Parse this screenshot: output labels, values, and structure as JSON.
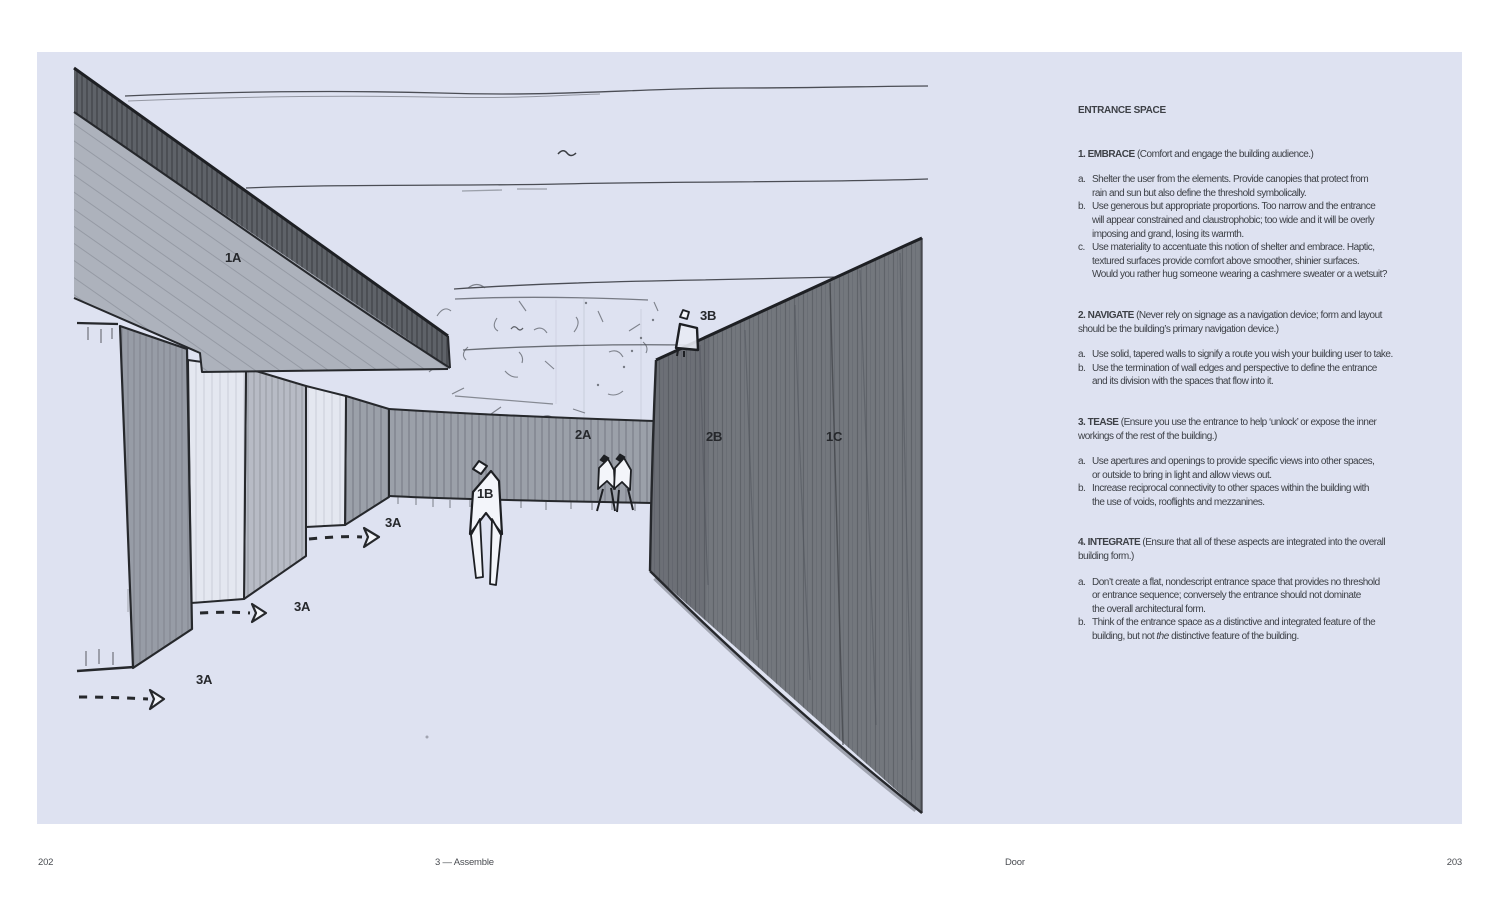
{
  "colors": {
    "page_bg": "#ffffff",
    "panel_bg": "#dee2f1",
    "ink": "#26282c",
    "text": "#3d4046",
    "footer_text": "#4a4d52",
    "wall_dark": "#73777d",
    "wall_band": "#9ba0a9",
    "fin_dark": "#979ca6",
    "fin_mid": "#b7bbc5",
    "fin_light": "#e4e7f0",
    "fascia": "#5e6268",
    "canopy_under": "#adb2bc",
    "figure_fill": "#f3f5fa"
  },
  "sketch": {
    "description": "hand sketch of an entrance corridor in one-point perspective",
    "labels": {
      "l1a": "1A",
      "l1b": "1B",
      "l1c": "1C",
      "l2a": "2A",
      "l2b": "2B",
      "l3b": "3B",
      "l3a_1": "3A",
      "l3a_2": "3A",
      "l3a_3": "3A"
    }
  },
  "article": {
    "title": "ENTRANCE SPACE",
    "sections": [
      {
        "heading_bold": "1. EMBRACE",
        "heading_rest": " (Comfort and engage the building audience.)",
        "items": [
          {
            "label": "a.",
            "text": "Shelter the user from the elements. Provide canopies that protect from\nrain and sun but also define the threshold symbolically."
          },
          {
            "label": "b.",
            "text": "Use generous but appropriate proportions. Too narrow and the entrance\nwill appear constrained and claustrophobic; too wide and it will be overly\nimposing and grand, losing its warmth."
          },
          {
            "label": "c.",
            "text": "Use materiality to accentuate this notion of shelter and embrace. Haptic,\ntextured surfaces provide comfort above smoother, shinier surfaces.\nWould you rather hug someone wearing a cashmere sweater or a wetsuit?"
          }
        ]
      },
      {
        "heading_bold": "2. NAVIGATE",
        "heading_rest": " (Never rely on signage as a navigation device; form and layout\nshould be the building’s primary navigation device.)",
        "items": [
          {
            "label": "a.",
            "text": "Use solid, tapered walls to signify a route you wish your building user to take."
          },
          {
            "label": "b.",
            "text": "Use the termination of wall edges and perspective to define the entrance\nand its division with the spaces that flow into it."
          }
        ]
      },
      {
        "heading_bold": "3. TEASE",
        "heading_rest": " (Ensure you use the entrance to help ‘unlock’ or expose the inner\nworkings of the rest of the building.)",
        "items": [
          {
            "label": "a.",
            "text": "Use apertures and openings to provide specific views into other spaces,\nor outside to bring in light and allow views out."
          },
          {
            "label": "b.",
            "text": "Increase reciprocal connectivity to other spaces within the building with\nthe use of voids, rooflights and mezzanines."
          }
        ]
      },
      {
        "heading_bold": "4. INTEGRATE",
        "heading_rest": " (Ensure that all of these aspects are integrated into the overall\nbuilding form.)",
        "items": [
          {
            "label": "a.",
            "text": "Don’t create a flat, nondescript entrance space that provides no threshold\nor entrance sequence; conversely the entrance should not dominate\nthe overall architectural form."
          },
          {
            "label": "b.",
            "pre": "Think of the entrance space as ",
            "italic1": "a",
            "mid": " distinctive and integrated feature of the\nbuilding, but not ",
            "italic2": "the",
            "post": " distinctive feature of the building."
          }
        ]
      }
    ]
  },
  "footer": {
    "left_page_number": "202",
    "left_caption": "3 — Assemble",
    "right_caption": "Door",
    "right_page_number": "203"
  }
}
